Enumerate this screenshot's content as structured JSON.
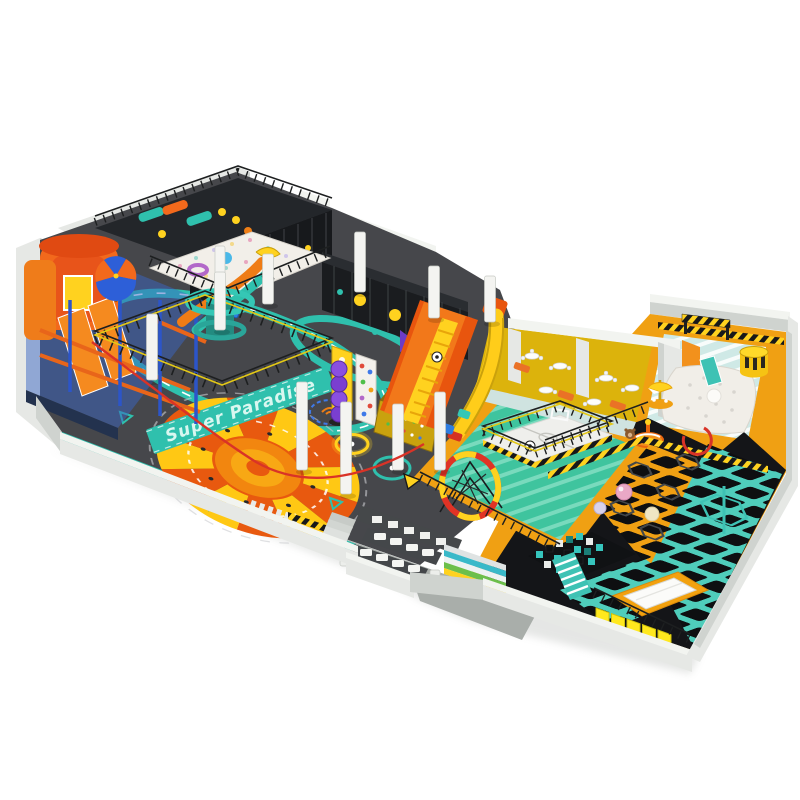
{
  "title": "Indoor Playground Park — 3D Isometric Render",
  "description": "Large indoor soft-play park: ropes course, ball pits, slides, soccer court, cafe seating, toddler zone, trampoline grids, foam pit and entrance benches.",
  "floor_text": {
    "super_paradise": "Super Paradise"
  },
  "palette": {
    "background": "#ffffff",
    "wall_light": "#e6e8e5",
    "wall_mid": "#cfd3cf",
    "floor_dark": "#46474b",
    "floor_black": "#141518",
    "floor_green": "#3fc49e",
    "floor_toddler": "#cfe9e6",
    "path_gold": "#f0a013",
    "teal": "#2fc0ad",
    "yellow": "#ffd21f",
    "orange": "#f07f16",
    "deep_orange": "#e8590f",
    "red": "#d93327",
    "entrance_gray": "#a9aeaa",
    "ballpit_white": "#f2efe9",
    "cafe_floor": "#dcb30c"
  }
}
